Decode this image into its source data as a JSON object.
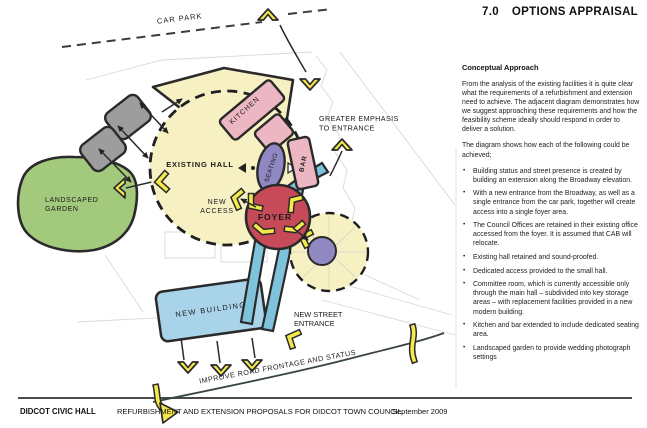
{
  "header": {
    "section": "7.0",
    "title": "OPTIONS APPRAISAL"
  },
  "sidebar": {
    "heading": "Conceptual Approach",
    "para1": "From the analysis of the existing facilities it is quite clear what the requirements of a refurbishment and extension need to achieve.  The adjacent diagram demonstrates how we suggest approaching these requirements and how the feasibility scheme ideally should respond in order to deliver a solution.",
    "para2": "The diagram shows how each of the following could be achieved;",
    "bullets": [
      "Building status and street presence is created by building an extension along the Broadway elevation.",
      "With a new entrance from the Broadway, as well as a single entrance from the car park, together will create access into a single foyer area.",
      "The Council Offices are retained in their existing office accessed from the foyer.  It is assumed that CAB will relocate.",
      "Existing hall retained and sound-proofed.",
      "Dedicated access provided to the small hall.",
      "Committee room, which is currently accessible only through the main hall – subdivided into key storage areas – with replacement facilities provided in a new modern building.",
      "Kitchen and bar extended to include dedicated seating area.",
      "Landscaped garden to provide wedding photograph settings"
    ]
  },
  "diagram": {
    "labels": {
      "car_park": "CAR PARK",
      "existing_hall": "EXISTING HALL",
      "kitchen": "KITCHEN",
      "seating": "SEATING",
      "bar": "BAR",
      "garden": [
        "LANDSCAPED",
        "GARDEN"
      ],
      "new_access": [
        "NEW",
        "ACCESS"
      ],
      "foyer": "FOYER",
      "emphasis": [
        "GREATER EMPHASIS",
        "TO ENTRANCE"
      ],
      "new_building": "NEW BUILDING",
      "street_entrance": [
        "NEW STREET",
        "ENTRANCE"
      ],
      "road": "IMPROVE ROAD FRONTAGE AND STATUS"
    },
    "colors": {
      "pale_yellow": "#f6f0c2",
      "pink": "#ecb7c3",
      "purple": "#9088c2",
      "green": "#a3c97d",
      "building_blue": "#a9d3e9",
      "swoosh_blue": "#7fc3da",
      "foyer_red": "#c64a57",
      "arrow_yellow": "#f4e94b",
      "gray_block": "#9d9d9d",
      "outline_dark": "#2a2a2a"
    }
  },
  "footer": {
    "left": "DIDCOT CIVIC HALL",
    "center": "REFURBISHMENT AND EXTENSION PROPOSALS FOR DIDCOT TOWN COUNCIL",
    "right": "September 2009"
  }
}
